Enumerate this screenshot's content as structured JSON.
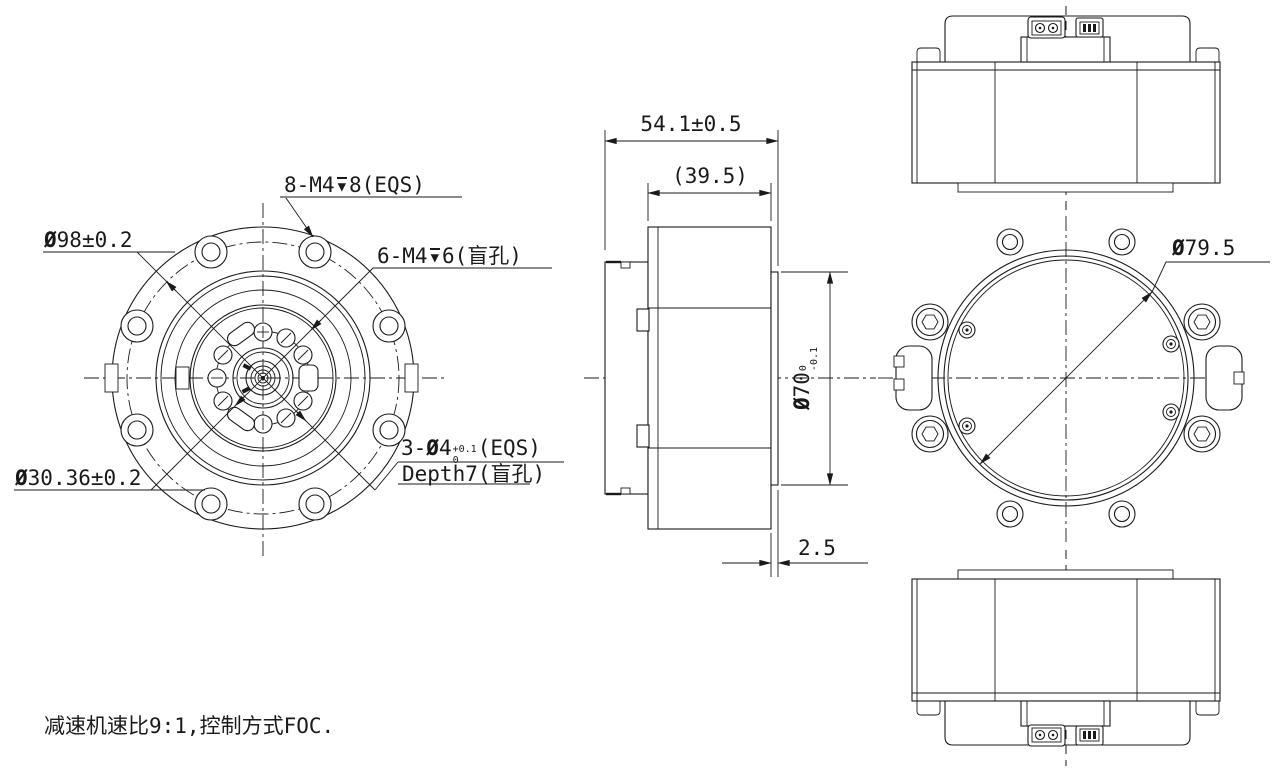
{
  "drawing": {
    "note": "减速机速比9:1,控制方式FOC.",
    "symbols": {
      "depth": "▼"
    },
    "front_view": {
      "bolt_circle_dia": {
        "dia": "Ø",
        "value": "98",
        "tol": "±0.2"
      },
      "inner_bolt_circle_dia": {
        "dia": "Ø",
        "value": "30.36",
        "tol": "±0.2"
      },
      "mount_holes": {
        "prefix": "8-M4",
        "suffix": "8(EQS)"
      },
      "blind_holes": {
        "prefix": "6-M4",
        "suffix": "6(盲孔)"
      },
      "pin_holes": {
        "prefix": "3-",
        "dia": "Ø",
        "value": "4",
        "tol_upper": "+0.1",
        "tol_lower": "0",
        "suffix": "(EQS)",
        "line2": "Depth7(盲孔)"
      }
    },
    "side_view": {
      "overall_width": "54.1±0.5",
      "body_width": "(39.5)",
      "flange_dia": {
        "dia": "Ø",
        "value": "70",
        "tol_upper": "0",
        "tol_lower": "-0.1"
      },
      "flange_thickness": "2.5"
    },
    "rear_view": {
      "inner_dia": {
        "dia": "Ø",
        "value": "79.5"
      }
    }
  }
}
